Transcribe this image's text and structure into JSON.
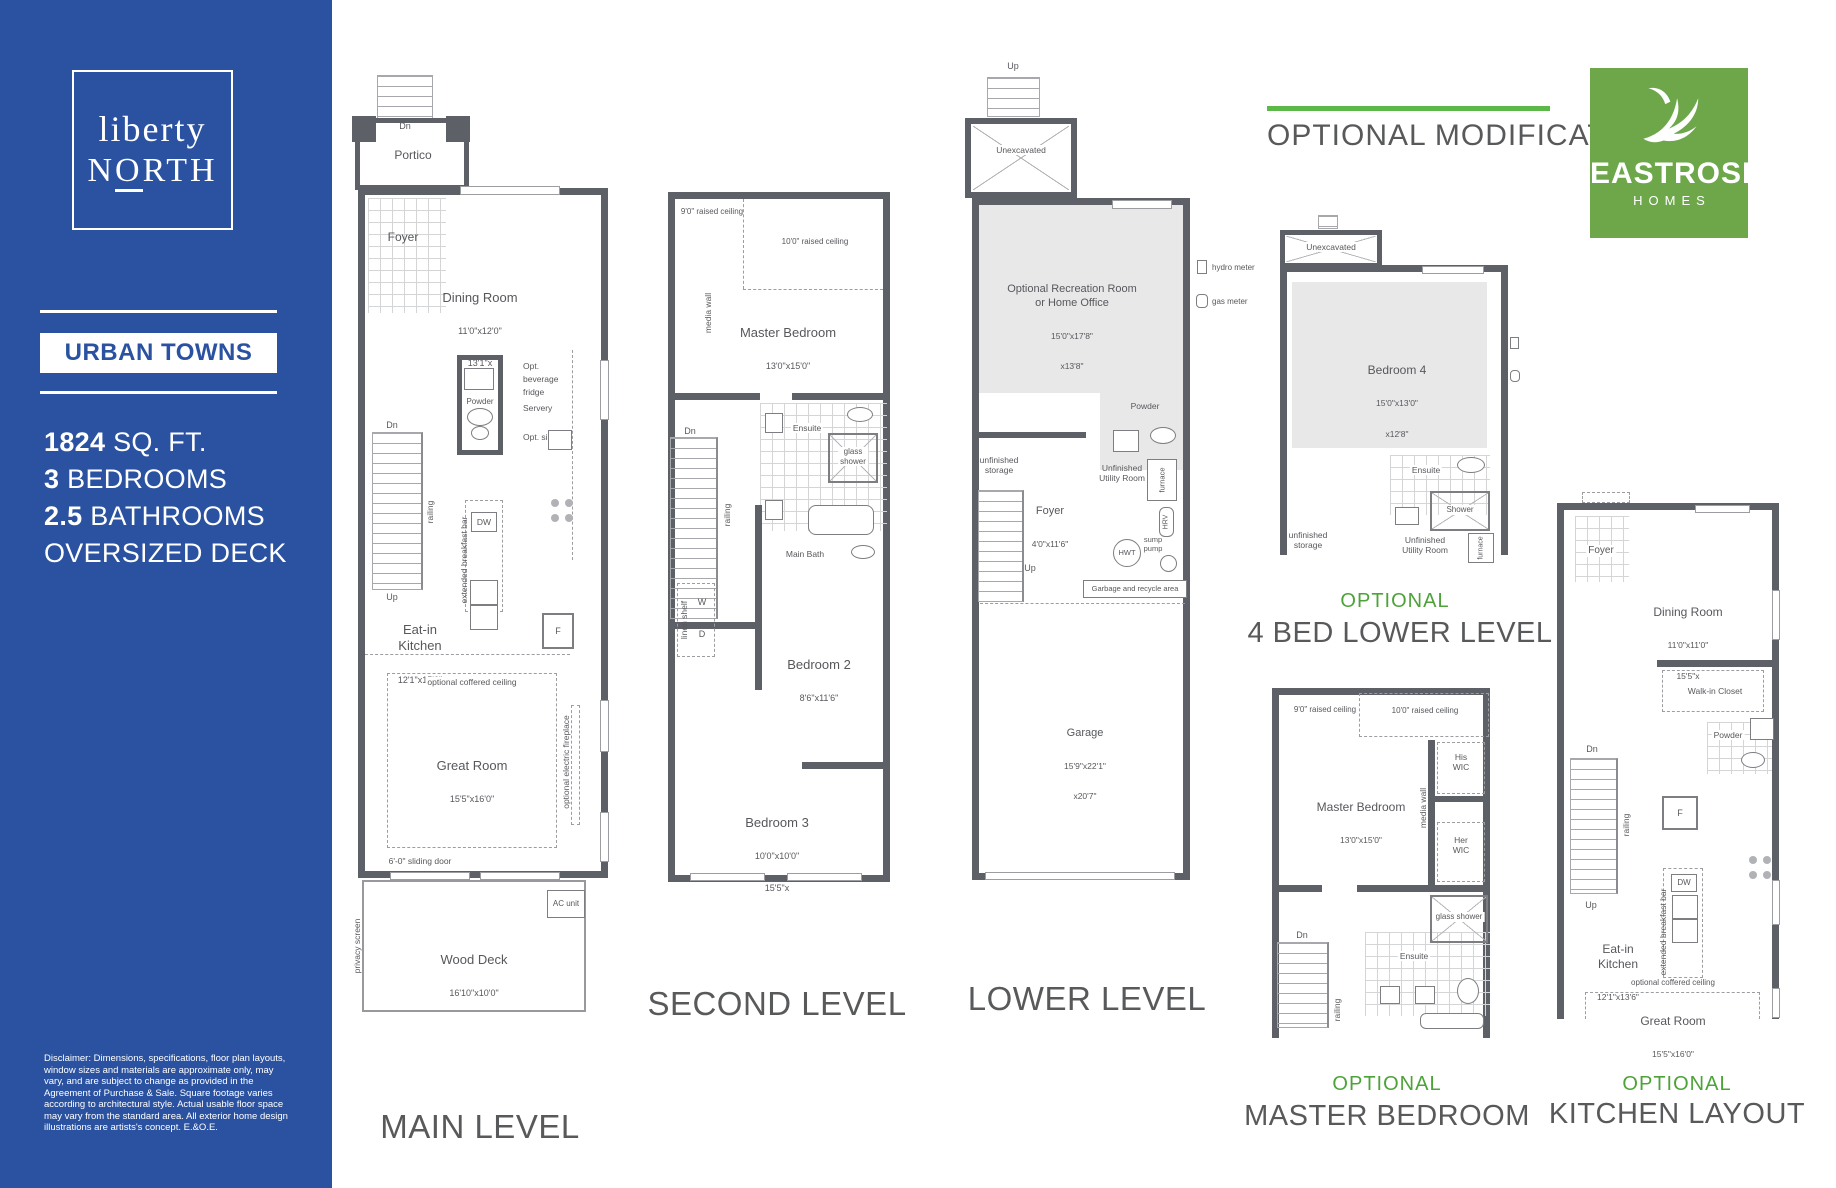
{
  "colors": {
    "sidebar_blue": "#2a52a0",
    "green_line": "#5cb848",
    "green_text": "#4da339",
    "logo_green": "#6da74a",
    "wall_gray": "#5d6066",
    "text_gray": "#58595b"
  },
  "sidebar": {
    "logo_line1": "liberty",
    "logo_n1": "N",
    "logo_o": "O",
    "logo_n2": "RTH",
    "community": "URBAN TOWNS",
    "specs": [
      {
        "b": "1824",
        "t": " SQ. FT."
      },
      {
        "b": "3",
        "t": " BEDROOMS"
      },
      {
        "b": "2.5",
        "t": " BATHROOMS"
      },
      {
        "b": "",
        "t": "OVERSIZED DECK"
      }
    ],
    "disclaimer": "Disclaimer: Dimensions, specifications, floor plan layouts, window sizes and materials are approximate only, may vary, and are subject to change as provided in the Agreement of Purchase & Sale. Square footage varies according to architectural style. Actual usable floor space may vary from the standard area. All exterior home design illustrations are artists's concept. E.&O.E."
  },
  "header": {
    "optional_modifications": "OPTIONAL MODIFICATIONS"
  },
  "brand": {
    "name": "EASTROSE",
    "sub": "HOMES"
  },
  "main_level": {
    "title": "MAIN LEVEL",
    "dn_top": "Dn",
    "portico": "Portico",
    "foyer": "Foyer",
    "dining_nm": "Dining Room",
    "dining_d1": "11'0\"x12'0\"",
    "dining_d2": "13'1\"x",
    "powder": "Powder",
    "opt_fridge": "Opt.\nbeverage\nfridge",
    "servery": "Servery",
    "opt_sink": "Opt. sink",
    "dn": "Dn",
    "up": "Up",
    "railing": "railing",
    "dw": "DW",
    "bar": "extended breakfast bar",
    "fridge": "F",
    "kitchen_nm": "Eat-in\nKitchen",
    "kitchen_d": "12'1\"x15'0\"",
    "coffered": "optional coffered ceiling",
    "great_nm": "Great Room",
    "great_d": "15'5\"x16'0\"",
    "fireplace": "optional electric fireplace",
    "sliding_door": "6'-0\" sliding door",
    "ac_unit": "AC unit",
    "deck_nm": "Wood Deck",
    "deck_d": "16'10\"x10'0\"",
    "privacy": "privacy screen"
  },
  "second_level": {
    "title": "SECOND LEVEL",
    "rc9": "9'0\" raised ceiling",
    "rc10": "10'0\" raised ceiling",
    "media_wall": "media wall",
    "master_nm": "Master Bedroom",
    "master_d": "13'0\"x15'0\"",
    "ensuite": "Ensuite",
    "glass_shower": "glass\nshower",
    "dn": "Dn",
    "railing": "railing",
    "main_bath": "Main Bath",
    "linen": "linen shelf",
    "w": "W",
    "d": "D",
    "b2_nm": "Bedroom 2",
    "b2_d": "8'6\"x11'6\"",
    "b3_nm": "Bedroom 3",
    "b3_d1": "10'0\"x10'0\"",
    "b3_d2": "15'5\"x"
  },
  "lower_level": {
    "title": "LOWER LEVEL",
    "up_top": "Up",
    "unexcavated": "Unexcavated",
    "rec_nm": "Optional Recreation Room\nor Home Office",
    "rec_d1": "15'0\"x17'8\"",
    "rec_d2": "x13'8\"",
    "hydro": "hydro meter",
    "gas": "gas meter",
    "powder": "Powder",
    "storage": "unfinished\nstorage",
    "foyer_nm": "Foyer",
    "foyer_d": "4'0\"x11'6\"",
    "utility": "Unfinished\nUtility Room",
    "furnace": "furnace",
    "hrv": "HRV",
    "hwt": "HWT",
    "sump": "sump\npump",
    "up": "Up",
    "garbage": "Garbage and recycle area",
    "garage_nm": "Garage",
    "garage_d1": "15'9\"x22'1\"",
    "garage_d2": "x20'7\""
  },
  "opt_lower": {
    "tag": "OPTIONAL",
    "title": "4 BED LOWER LEVEL",
    "unexcavated": "Unexcavated",
    "b4_nm": "Bedroom 4",
    "b4_d1": "15'0\"x13'0\"",
    "b4_d2": "x12'8\"",
    "ensuite": "Ensuite",
    "shower": "Shower",
    "storage": "unfinished\nstorage",
    "utility": "Unfinished\nUtility Room",
    "furnace": "furnace"
  },
  "opt_master": {
    "tag": "OPTIONAL",
    "title": "MASTER BEDROOM",
    "rc9": "9'0\" raised ceiling",
    "rc10": "10'0\" raised ceiling",
    "master_nm": "Master Bedroom",
    "master_d": "13'0\"x15'0\"",
    "media_wall": "media wall",
    "his_wic": "His\nWIC",
    "her_wic": "Her\nWIC",
    "glass_shower": "glass shower",
    "dn": "Dn",
    "railing": "railing",
    "ensuite": "Ensuite"
  },
  "opt_kitchen": {
    "tag": "OPTIONAL",
    "title": "KITCHEN LAYOUT",
    "foyer": "Foyer",
    "dining_nm": "Dining Room",
    "dining_d1": "11'0\"x11'0\"",
    "dining_d2": "15'5\"x",
    "wic": "Walk-in Closet",
    "powder": "Powder",
    "dn": "Dn",
    "railing": "railing",
    "up": "Up",
    "fridge": "F",
    "dw": "DW",
    "bar": "extended breakfast bar",
    "kitchen_nm": "Eat-in\nKitchen",
    "kitchen_d": "12'1\"x13'6\"",
    "coffered": "optional coffered ceiling",
    "great_nm": "Great Room",
    "great_d": "15'5\"x16'0\""
  }
}
